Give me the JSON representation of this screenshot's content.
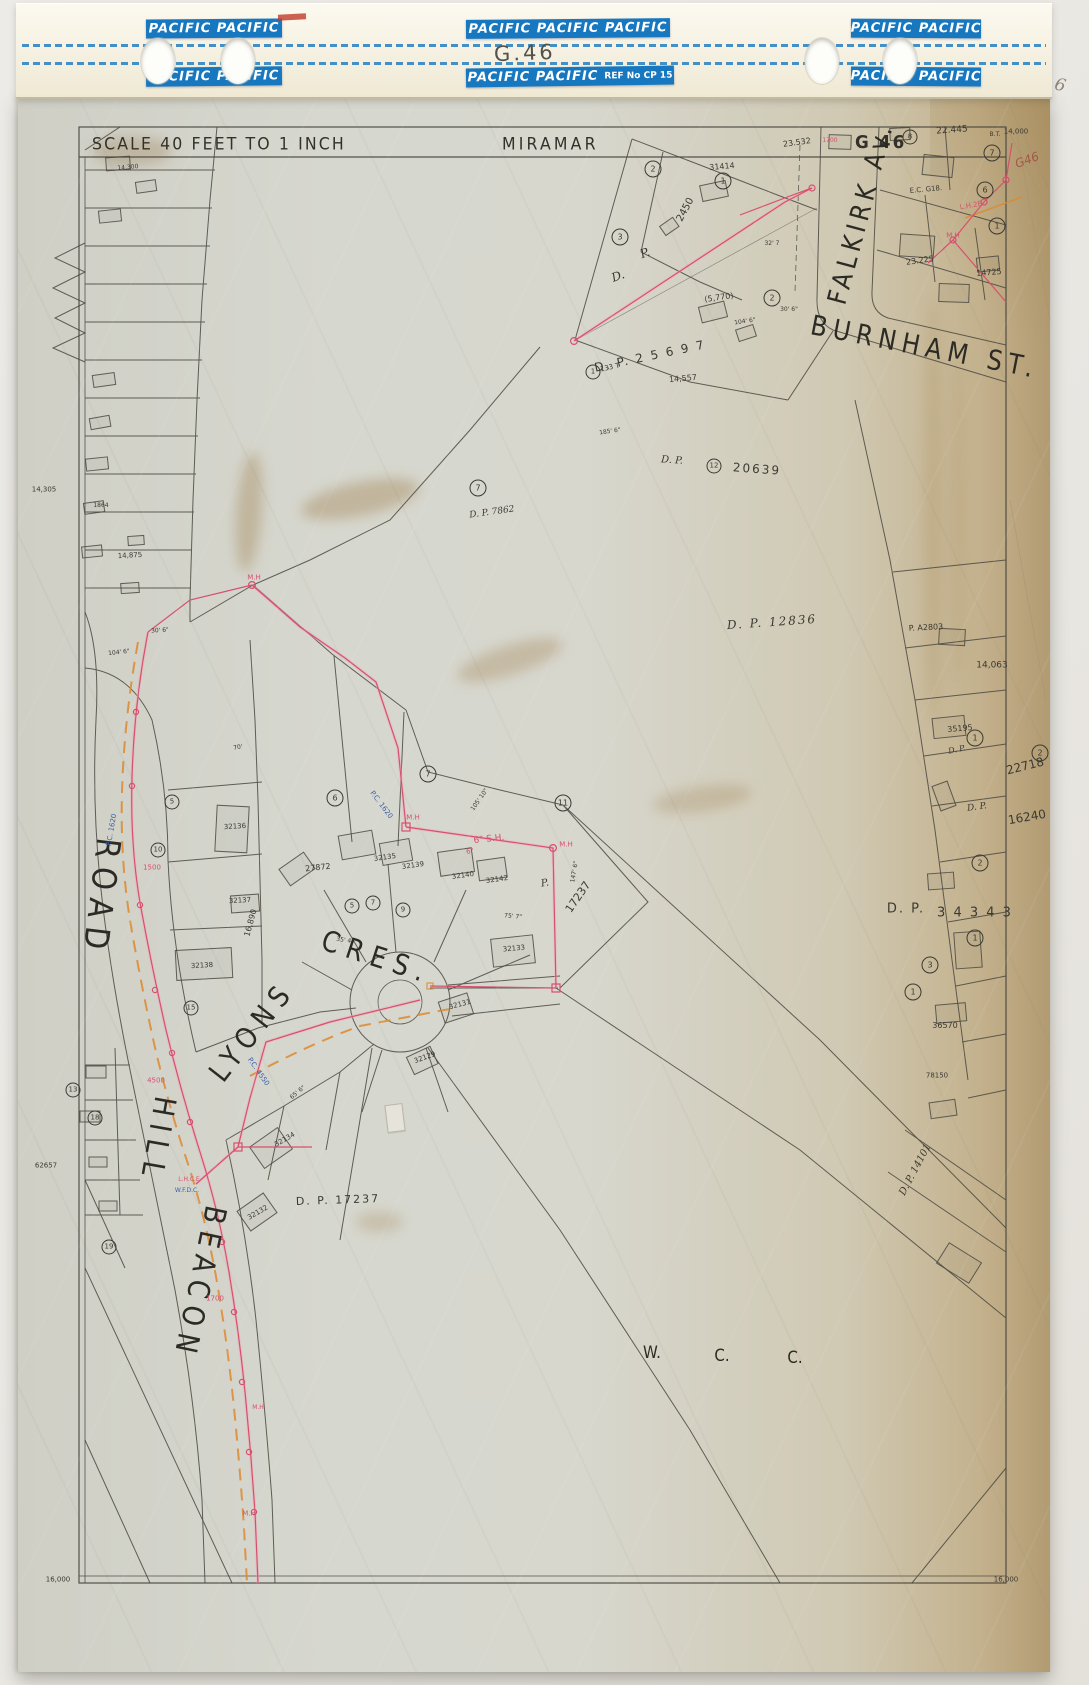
{
  "header": {
    "tape_label_double": "PACIFIC PACIFIC",
    "tape_label_triple": "PACIFIC PACIFIC PACIFIC",
    "tape_ref": "REF No CP 15",
    "sheet_code_handwritten": "G.46"
  },
  "titlebar": {
    "scale": "SCALE  40 FEET  TO  1 INCH",
    "area": "MIRAMAR",
    "sheet": "G 46"
  },
  "colors": {
    "tape_blue": "#1878bf",
    "survey_red": "#d6506e",
    "survey_orange": "#dd8a2f",
    "note_blue": "#3a5fa8",
    "pencil_red": "#a05848",
    "pencil_grey": "#8d8678",
    "paper": "#d6d7ce",
    "aged_edge": "#b29b72",
    "ink": "#3b3933"
  },
  "map": {
    "labels": [
      {
        "n": "street-falkirk-av",
        "t": "FALKIRK Av.",
        "x": 862,
        "y": 213,
        "r": -75,
        "s": 23,
        "ls": 5,
        "cls": "street"
      },
      {
        "n": "street-burnham-st",
        "t": "BURNHAM ST.",
        "x": 925,
        "y": 347,
        "r": 11,
        "s": 24,
        "ls": 6,
        "cls": "street"
      },
      {
        "n": "street-beacon",
        "t": "BEACON",
        "x": 199,
        "y": 1283,
        "r": 102,
        "s": 26,
        "ls": 8,
        "cls": "street"
      },
      {
        "n": "street-hill",
        "t": "HILL",
        "x": 157,
        "y": 1140,
        "r": 100,
        "s": 26,
        "ls": 8,
        "cls": "street"
      },
      {
        "n": "street-road",
        "t": "ROAD",
        "x": 101,
        "y": 898,
        "r": 97,
        "s": 29,
        "ls": 9,
        "cls": "street"
      },
      {
        "n": "street-lyons",
        "t": "LYONS",
        "x": 252,
        "y": 1031,
        "r": -52,
        "s": 25,
        "ls": 8,
        "cls": "street"
      },
      {
        "n": "street-cres",
        "t": "CRES.",
        "x": 377,
        "y": 957,
        "r": 18,
        "s": 25,
        "ls": 8,
        "cls": "street"
      },
      {
        "n": "wcc-w",
        "t": "W.",
        "x": 652,
        "y": 1353,
        "s": 15,
        "cls": "street"
      },
      {
        "n": "wcc-c1",
        "t": "C.",
        "x": 722,
        "y": 1356,
        "s": 15,
        "cls": "street"
      },
      {
        "n": "wcc-c2",
        "t": "C.",
        "x": 795,
        "y": 1358,
        "s": 15,
        "cls": "street"
      },
      {
        "n": "plan-dp25697",
        "t": "D. P.  2 5 6 9 7",
        "x": 650,
        "y": 356,
        "r": -12,
        "s": 12,
        "ls": 2
      },
      {
        "n": "plan-d",
        "t": "D.",
        "x": 618,
        "y": 276,
        "r": -20,
        "s": 12,
        "cls": "script"
      },
      {
        "n": "plan-p",
        "t": "P.",
        "x": 645,
        "y": 253,
        "r": -20,
        "s": 12,
        "cls": "script"
      },
      {
        "n": "plan-133t",
        "t": "133 T",
        "x": 610,
        "y": 368,
        "r": -12,
        "s": 7
      },
      {
        "n": "plan-dp20639-dp",
        "t": "D. P.",
        "x": 672,
        "y": 461,
        "r": 4,
        "s": 10,
        "cls": "script"
      },
      {
        "n": "plan-dp20639",
        "t": "20639",
        "x": 757,
        "y": 469,
        "r": 4,
        "s": 12,
        "ls": 2
      },
      {
        "n": "plan-dp12836",
        "t": "D.  P.  12836",
        "x": 772,
        "y": 622,
        "r": -4,
        "s": 12,
        "ls": 2,
        "cls": "script"
      },
      {
        "n": "plan-dp7862",
        "t": "D. P. 7862",
        "x": 492,
        "y": 513,
        "r": -8,
        "s": 9,
        "cls": "script"
      },
      {
        "n": "plan-17237-p",
        "t": "P.",
        "x": 545,
        "y": 884,
        "r": -10,
        "s": 10,
        "cls": "script"
      },
      {
        "n": "plan-17237",
        "t": "17237",
        "x": 578,
        "y": 897,
        "r": -55,
        "s": 11
      },
      {
        "n": "plan-dp17237",
        "t": "D. P.  17237",
        "x": 338,
        "y": 1200,
        "r": -2,
        "s": 11,
        "ls": 2
      },
      {
        "n": "plan-dp34343-dp",
        "t": "D. P.",
        "x": 906,
        "y": 909,
        "s": 13,
        "ls": 2
      },
      {
        "n": "plan-dp34343",
        "t": "3 4 3 4 3",
        "x": 975,
        "y": 913,
        "s": 13,
        "ls": 2
      },
      {
        "n": "plan-22718",
        "t": "22718",
        "x": 1025,
        "y": 766,
        "r": -14,
        "s": 12
      },
      {
        "n": "plan-16240",
        "t": "16240",
        "x": 1027,
        "y": 817,
        "r": -10,
        "s": 12
      },
      {
        "n": "plan-16240-dp",
        "t": "D. P.",
        "x": 977,
        "y": 808,
        "r": -8,
        "s": 9,
        "cls": "script"
      },
      {
        "n": "plan-dp-script",
        "t": "D. P.",
        "x": 957,
        "y": 750,
        "r": -12,
        "s": 8,
        "cls": "script"
      },
      {
        "n": "plan-dp14101",
        "t": "D. P. 14101",
        "x": 916,
        "y": 1170,
        "r": -62,
        "s": 10,
        "cls": "script"
      },
      {
        "n": "num",
        "t": "23.532",
        "x": 797,
        "y": 143,
        "r": -8,
        "s": 8
      },
      {
        "n": "num",
        "t": "22.445",
        "x": 952,
        "y": 131,
        "r": -4,
        "s": 9
      },
      {
        "n": "num",
        "t": "14,000",
        "x": 1016,
        "y": 132,
        "s": 7
      },
      {
        "n": "num",
        "t": "B.T.",
        "x": 995,
        "y": 135,
        "s": 6
      },
      {
        "n": "num",
        "t": "E.C. G18.",
        "x": 926,
        "y": 190,
        "r": -5,
        "s": 7
      },
      {
        "n": "num",
        "t": "23.225",
        "x": 920,
        "y": 261,
        "r": -8,
        "s": 8
      },
      {
        "n": "num",
        "t": "14725",
        "x": 989,
        "y": 273,
        "r": -5,
        "s": 8
      },
      {
        "n": "num",
        "t": "31414",
        "x": 722,
        "y": 167,
        "r": -5,
        "s": 8
      },
      {
        "n": "num",
        "t": "(5,770)",
        "x": 719,
        "y": 298,
        "r": -8,
        "s": 8
      },
      {
        "n": "num",
        "t": "2450",
        "x": 686,
        "y": 210,
        "r": -62,
        "s": 10
      },
      {
        "n": "num",
        "t": "14,557",
        "x": 683,
        "y": 379,
        "r": -5,
        "s": 8
      },
      {
        "n": "num",
        "t": "14,063",
        "x": 992,
        "y": 666,
        "s": 9
      },
      {
        "n": "num",
        "t": "35195",
        "x": 960,
        "y": 729,
        "r": -5,
        "s": 8
      },
      {
        "n": "num",
        "t": "P. A2803",
        "x": 926,
        "y": 628,
        "r": -3,
        "s": 8
      },
      {
        "n": "num",
        "t": "36570",
        "x": 945,
        "y": 1026,
        "s": 8
      },
      {
        "n": "num",
        "t": "78150",
        "x": 937,
        "y": 1076,
        "s": 7
      },
      {
        "n": "num",
        "t": "16,000",
        "x": 58,
        "y": 1580,
        "s": 7
      },
      {
        "n": "num",
        "t": "16,000",
        "x": 1006,
        "y": 1580,
        "s": 7
      },
      {
        "n": "num",
        "t": "14,305",
        "x": 44,
        "y": 490,
        "s": 7
      },
      {
        "n": "num",
        "t": "14,875",
        "x": 130,
        "y": 556,
        "r": -3,
        "s": 7
      },
      {
        "n": "num",
        "t": "1864",
        "x": 101,
        "y": 506,
        "s": 6
      },
      {
        "n": "num",
        "t": "62657",
        "x": 46,
        "y": 1166,
        "s": 7
      },
      {
        "n": "num",
        "t": "14,300",
        "x": 128,
        "y": 168,
        "r": -5,
        "s": 6
      },
      {
        "n": "num",
        "t": "27872",
        "x": 318,
        "y": 868,
        "r": -6,
        "s": 8
      },
      {
        "n": "num",
        "t": "32135",
        "x": 385,
        "y": 858,
        "r": -8,
        "s": 7
      },
      {
        "n": "num",
        "t": "32139",
        "x": 413,
        "y": 866,
        "r": -8,
        "s": 7
      },
      {
        "n": "num",
        "t": "32140",
        "x": 463,
        "y": 876,
        "r": -8,
        "s": 7
      },
      {
        "n": "num",
        "t": "32142",
        "x": 497,
        "y": 880,
        "r": -8,
        "s": 7
      },
      {
        "n": "num",
        "t": "32136",
        "x": 235,
        "y": 827,
        "r": -3,
        "s": 7
      },
      {
        "n": "num",
        "t": "32137",
        "x": 240,
        "y": 901,
        "r": -3,
        "s": 7
      },
      {
        "n": "num",
        "t": "32138",
        "x": 202,
        "y": 966,
        "r": -3,
        "s": 7
      },
      {
        "n": "num",
        "t": "32133",
        "x": 514,
        "y": 949,
        "r": -5,
        "s": 7
      },
      {
        "n": "num",
        "t": "32131",
        "x": 460,
        "y": 1005,
        "r": -15,
        "s": 7
      },
      {
        "n": "num",
        "t": "32129",
        "x": 425,
        "y": 1058,
        "r": -20,
        "s": 7
      },
      {
        "n": "num",
        "t": "32134",
        "x": 285,
        "y": 1140,
        "r": -30,
        "s": 7
      },
      {
        "n": "num",
        "t": "32132",
        "x": 258,
        "y": 1213,
        "r": -30,
        "s": 7
      },
      {
        "n": "num",
        "t": "16,890",
        "x": 251,
        "y": 923,
        "r": -75,
        "s": 8
      },
      {
        "n": "dim",
        "t": "32' 7",
        "x": 772,
        "y": 244,
        "s": 6
      },
      {
        "n": "dim",
        "t": "30' 6\"",
        "x": 789,
        "y": 310,
        "s": 6
      },
      {
        "n": "dim",
        "t": "104' 6\"",
        "x": 745,
        "y": 322,
        "r": -8,
        "s": 6
      },
      {
        "n": "dim",
        "t": "104' 6\"",
        "x": 119,
        "y": 653,
        "r": -6,
        "s": 6
      },
      {
        "n": "dim",
        "t": "30' 6\"",
        "x": 160,
        "y": 631,
        "r": -4,
        "s": 6
      },
      {
        "n": "dim",
        "t": "185' 6\"",
        "x": 610,
        "y": 432,
        "r": -8,
        "s": 6
      },
      {
        "n": "dim",
        "t": "105' 10\"",
        "x": 480,
        "y": 800,
        "r": -55,
        "s": 6
      },
      {
        "n": "dim",
        "t": "75' 7\"",
        "x": 513,
        "y": 917,
        "r": 5,
        "s": 6
      },
      {
        "n": "dim",
        "t": "35' 4\"",
        "x": 345,
        "y": 941,
        "r": 8,
        "s": 6
      },
      {
        "n": "dim",
        "t": "65' 6\"",
        "x": 298,
        "y": 1093,
        "r": -40,
        "s": 6
      },
      {
        "n": "dim",
        "t": "70'",
        "x": 238,
        "y": 748,
        "r": -10,
        "s": 6
      },
      {
        "n": "dim",
        "t": "147' 6\"",
        "x": 575,
        "y": 872,
        "r": -80,
        "s": 6
      },
      {
        "n": "lot-circle",
        "t": "7",
        "x": 478,
        "y": 488,
        "s": 8,
        "cls": "circ"
      },
      {
        "n": "lot-circle",
        "t": "7",
        "x": 428,
        "y": 774,
        "s": 8,
        "cls": "circ"
      },
      {
        "n": "lot-circle",
        "t": "11",
        "x": 563,
        "y": 803,
        "s": 8,
        "cls": "circ"
      },
      {
        "n": "lot-circle",
        "t": "6",
        "x": 335,
        "y": 798,
        "s": 8,
        "cls": "circ"
      },
      {
        "n": "lot-circle",
        "t": "5",
        "x": 352,
        "y": 906,
        "s": 7,
        "cls": "circ"
      },
      {
        "n": "lot-circle",
        "t": "7",
        "x": 373,
        "y": 903,
        "s": 7,
        "cls": "circ"
      },
      {
        "n": "lot-circle",
        "t": "9",
        "x": 403,
        "y": 910,
        "s": 7,
        "cls": "circ"
      },
      {
        "n": "lot-circle",
        "t": "2",
        "x": 653,
        "y": 169,
        "s": 8,
        "cls": "circ"
      },
      {
        "n": "lot-circle",
        "t": "3",
        "x": 620,
        "y": 237,
        "s": 8,
        "cls": "circ"
      },
      {
        "n": "lot-circle",
        "t": "1",
        "x": 723,
        "y": 181,
        "s": 8,
        "cls": "circ"
      },
      {
        "n": "lot-circle",
        "t": "7",
        "x": 992,
        "y": 153,
        "s": 8,
        "cls": "circ"
      },
      {
        "n": "lot-circle",
        "t": "6",
        "x": 985,
        "y": 190,
        "s": 8,
        "cls": "circ"
      },
      {
        "n": "lot-circle",
        "t": "1",
        "x": 997,
        "y": 226,
        "s": 8,
        "cls": "circ"
      },
      {
        "n": "lot-circle",
        "t": "2",
        "x": 772,
        "y": 298,
        "s": 8,
        "cls": "circ"
      },
      {
        "n": "lot-circle",
        "t": "8",
        "x": 910,
        "y": 137,
        "s": 7,
        "cls": "circ"
      },
      {
        "n": "lot-circle",
        "t": "2",
        "x": 1040,
        "y": 753,
        "s": 8,
        "cls": "circ"
      },
      {
        "n": "lot-circle",
        "t": "1",
        "x": 975,
        "y": 738,
        "s": 8,
        "cls": "circ"
      },
      {
        "n": "lot-circle",
        "t": "2",
        "x": 980,
        "y": 863,
        "s": 8,
        "cls": "circ"
      },
      {
        "n": "lot-circle",
        "t": "1",
        "x": 975,
        "y": 938,
        "s": 8,
        "cls": "circ"
      },
      {
        "n": "lot-circle",
        "t": "3",
        "x": 930,
        "y": 965,
        "s": 8,
        "cls": "circ"
      },
      {
        "n": "lot-circle",
        "t": "1",
        "x": 913,
        "y": 992,
        "s": 8,
        "cls": "circ"
      },
      {
        "n": "lot-circle",
        "t": "13",
        "x": 73,
        "y": 1090,
        "s": 7,
        "cls": "circ"
      },
      {
        "n": "lot-circle",
        "t": "18",
        "x": 95,
        "y": 1118,
        "s": 7,
        "cls": "circ"
      },
      {
        "n": "lot-circle",
        "t": "19",
        "x": 109,
        "y": 1247,
        "s": 7,
        "cls": "circ"
      },
      {
        "n": "lot-circle",
        "t": "5",
        "x": 172,
        "y": 802,
        "s": 7,
        "cls": "circ"
      },
      {
        "n": "lot-circle",
        "t": "10",
        "x": 158,
        "y": 850,
        "s": 7,
        "cls": "circ"
      },
      {
        "n": "lot-circle",
        "t": "15",
        "x": 191,
        "y": 1008,
        "s": 7,
        "cls": "circ"
      },
      {
        "n": "lot-circle",
        "t": "1",
        "x": 593,
        "y": 372,
        "s": 7,
        "cls": "circ"
      },
      {
        "n": "lot-circle",
        "t": "12",
        "x": 714,
        "y": 466,
        "s": 7,
        "cls": "circ"
      },
      {
        "n": "survey-note",
        "t": "M.H",
        "x": 413,
        "y": 818,
        "s": 7,
        "cls": "red"
      },
      {
        "n": "survey-note",
        "t": "M.H",
        "x": 566,
        "y": 845,
        "s": 7,
        "cls": "red"
      },
      {
        "n": "survey-note",
        "t": "M.H",
        "x": 953,
        "y": 236,
        "s": 7,
        "cls": "red"
      },
      {
        "n": "survey-note",
        "t": "L.H.2E",
        "x": 971,
        "y": 206,
        "r": -10,
        "s": 7,
        "cls": "red"
      },
      {
        "n": "survey-note",
        "t": "L.H.C.E",
        "x": 189,
        "y": 1180,
        "s": 6,
        "cls": "red"
      },
      {
        "n": "survey-note",
        "t": "M.H",
        "x": 249,
        "y": 1514,
        "s": 7,
        "cls": "red"
      },
      {
        "n": "survey-note",
        "t": "M.H",
        "x": 254,
        "y": 578,
        "s": 7,
        "cls": "red"
      },
      {
        "n": "survey-note",
        "t": "M.H",
        "x": 258,
        "y": 1408,
        "s": 6,
        "cls": "red"
      },
      {
        "n": "survey-note",
        "t": "1500",
        "x": 152,
        "y": 868,
        "s": 7,
        "cls": "red"
      },
      {
        "n": "survey-note",
        "t": "4500",
        "x": 156,
        "y": 1081,
        "s": 7,
        "cls": "red"
      },
      {
        "n": "survey-note",
        "t": "1700",
        "x": 215,
        "y": 1299,
        "s": 7,
        "cls": "red"
      },
      {
        "n": "survey-note",
        "t": "1700",
        "x": 830,
        "y": 141,
        "s": 6,
        "cls": "red"
      },
      {
        "n": "survey-note",
        "t": "6\" S.H.",
        "x": 489,
        "y": 840,
        "r": -6,
        "s": 9,
        "cls": "red"
      },
      {
        "n": "survey-note",
        "t": "6\"",
        "x": 470,
        "y": 852,
        "r": -6,
        "s": 7,
        "cls": "red"
      },
      {
        "n": "pencil-note",
        "t": "G46",
        "x": 1027,
        "y": 160,
        "r": -20,
        "s": 12,
        "cls": "pencil"
      },
      {
        "n": "blue-note",
        "t": "P.C. 1620",
        "x": 381,
        "y": 805,
        "r": 53,
        "s": 7,
        "cls": "blue"
      },
      {
        "n": "blue-note",
        "t": "P.C. 4550",
        "x": 258,
        "y": 1072,
        "r": 55,
        "s": 7,
        "cls": "blue"
      },
      {
        "n": "blue-note",
        "t": "W.F.D.C.",
        "x": 187,
        "y": 1191,
        "s": 6,
        "cls": "blue"
      },
      {
        "n": "blue-note",
        "t": "P.C. 1620",
        "x": 112,
        "y": 830,
        "r": -80,
        "s": 7,
        "cls": "blue"
      },
      {
        "n": "margin-note-6",
        "t": "6",
        "x": 1060,
        "y": 86,
        "r": 14,
        "s": 17,
        "cls": "hand"
      }
    ]
  }
}
